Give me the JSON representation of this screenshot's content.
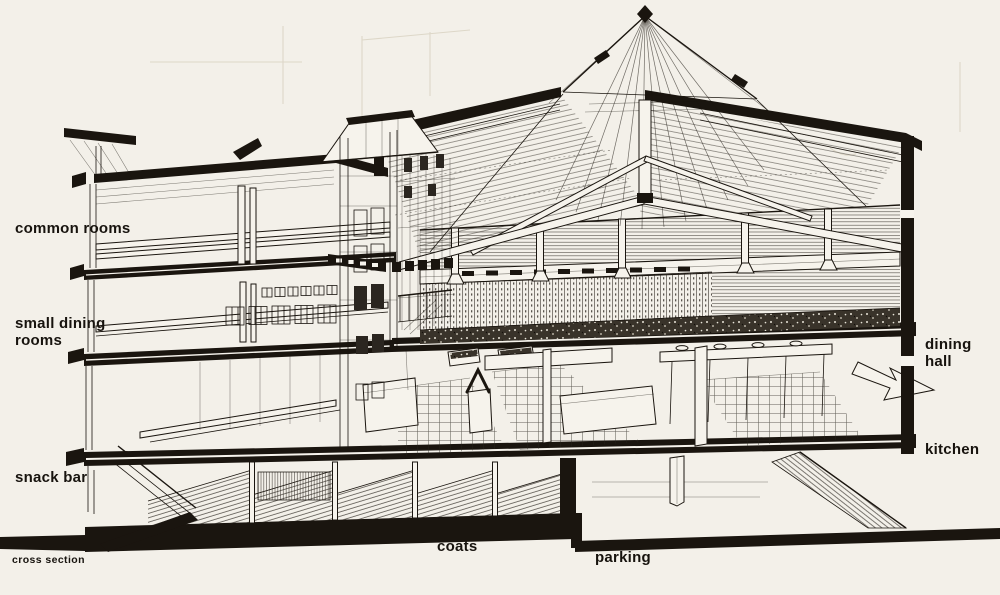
{
  "figure": {
    "type": "architectural sectional perspective drawing",
    "view": "cross section"
  },
  "labels": {
    "common_rooms": "common rooms",
    "small_dining_rooms": "small dining rooms",
    "snack_bar": "snack bar",
    "cross_section": "cross section",
    "coats": "coats",
    "parking": "parking",
    "dining_hall": "dining hall",
    "kitchen": "kitchen"
  },
  "colors": {
    "paper": "#f3f0e9",
    "ink": "#17130e"
  }
}
